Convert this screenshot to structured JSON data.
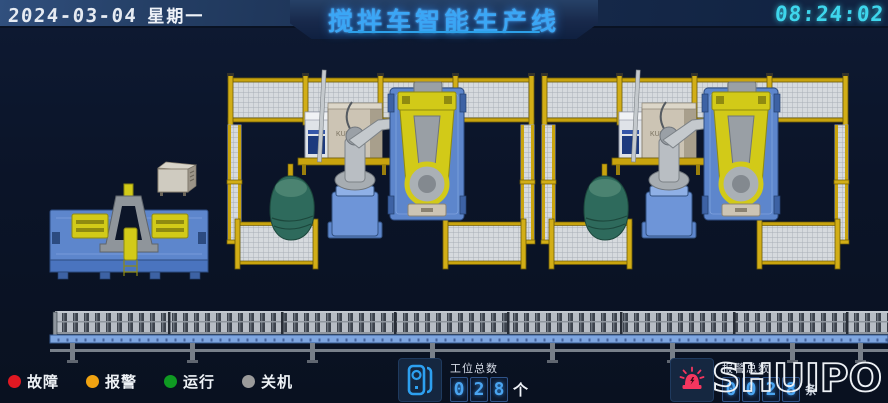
{
  "header": {
    "date": "2024-03-04",
    "weekday": "星期一",
    "title": "搅拌车智能生产线",
    "time": "08:24:02"
  },
  "status_legend": {
    "items": [
      {
        "label": "故障",
        "color": "#e01822"
      },
      {
        "label": "报警",
        "color": "#f0a311"
      },
      {
        "label": "运行",
        "color": "#0f9a22"
      },
      {
        "label": "关机",
        "color": "#9b9b9b"
      }
    ]
  },
  "counters": {
    "stations": {
      "label": "工位总数",
      "digits": [
        "0",
        "2",
        "8"
      ],
      "unit": "个",
      "icon": "station-device-icon"
    },
    "alarms": {
      "label": "报警总数",
      "digits": [
        "0",
        "0",
        "2",
        "8"
      ],
      "unit": "条",
      "icon": "alarm-beacon-icon"
    }
  },
  "logo": {
    "text": "SHUIPO"
  },
  "scene": {
    "robot_brand": "KUKA",
    "elements": [
      "fixture-station",
      "robot-cell-1",
      "robot-cell-2",
      "roller-conveyor"
    ]
  },
  "colors": {
    "title": "#3ba6f5",
    "time": "#3ed6ec",
    "digit": "#4aa4f0",
    "alarm_icon": "#f5365f",
    "station_icon": "#2da0f0",
    "fence_yellow": "#c9a40e",
    "machine_blue": "#5d86cc",
    "robot_yellow": "#d2ca18",
    "drum_green": "#2e6a5c"
  }
}
